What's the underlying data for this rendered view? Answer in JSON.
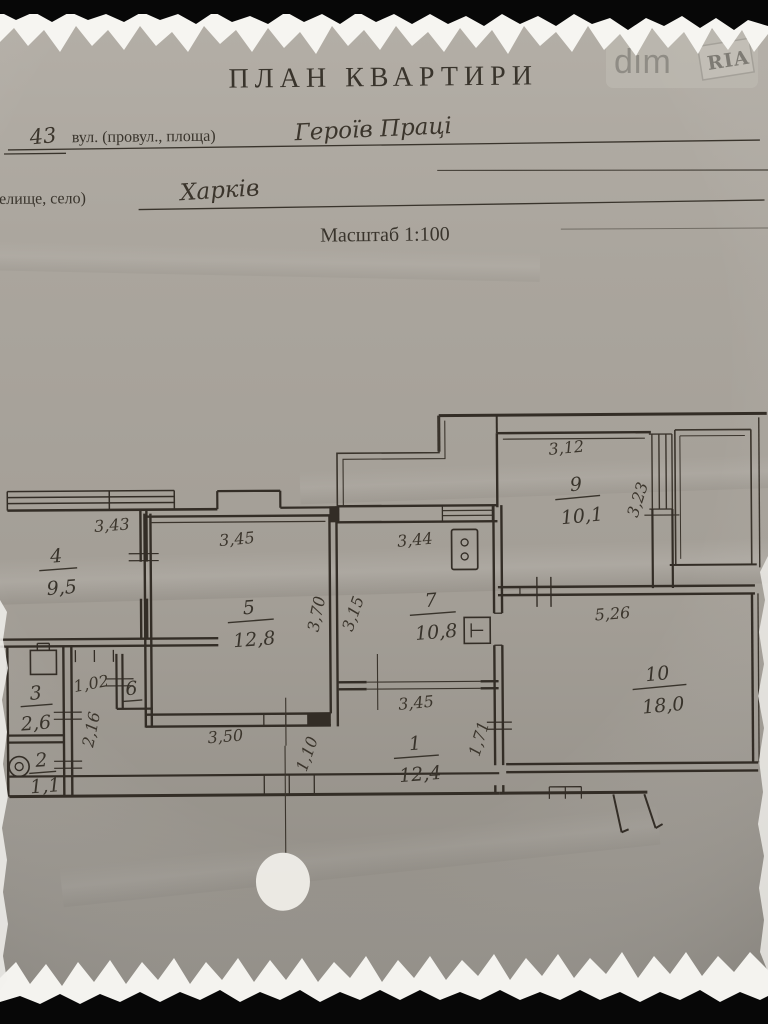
{
  "watermark": {
    "brand_left": "dim",
    "brand_right": "RIA"
  },
  "header": {
    "title": "ПЛАН КВАРТИРИ",
    "house_number": "43",
    "street_label": "вул. (провул., площа)",
    "street_value": "Героїв Праці",
    "settlement_label": "(селище, село)",
    "settlement_value": "Харків",
    "scale": "Масштаб 1:100"
  },
  "rooms": {
    "r1": {
      "num": "1",
      "area": "12,4"
    },
    "r2": {
      "num": "2",
      "area": "1,1"
    },
    "r3": {
      "num": "3",
      "area": "2,6"
    },
    "r4": {
      "num": "4",
      "area": "9,5"
    },
    "r5": {
      "num": "5",
      "area": "12,8"
    },
    "r6": {
      "num": "6",
      "area": ""
    },
    "r7": {
      "num": "7",
      "area": "10,8"
    },
    "r9": {
      "num": "9",
      "area": "10,1"
    },
    "r10": {
      "num": "10",
      "area": "18,0"
    }
  },
  "dims": {
    "top_room4": "3,43",
    "top_room5": "3,45",
    "top_room7": "3,44",
    "top_room9": "3,12",
    "right_room9": "3,23",
    "right_room5": "3,70",
    "left_room7": "3,15",
    "below_room9": "5,26",
    "hallway": "1,02",
    "left_wall": "2,16",
    "bottom_room5": "3,50",
    "top_room1": "3,45",
    "right_room1": "1,71",
    "passage": "1,10"
  }
}
